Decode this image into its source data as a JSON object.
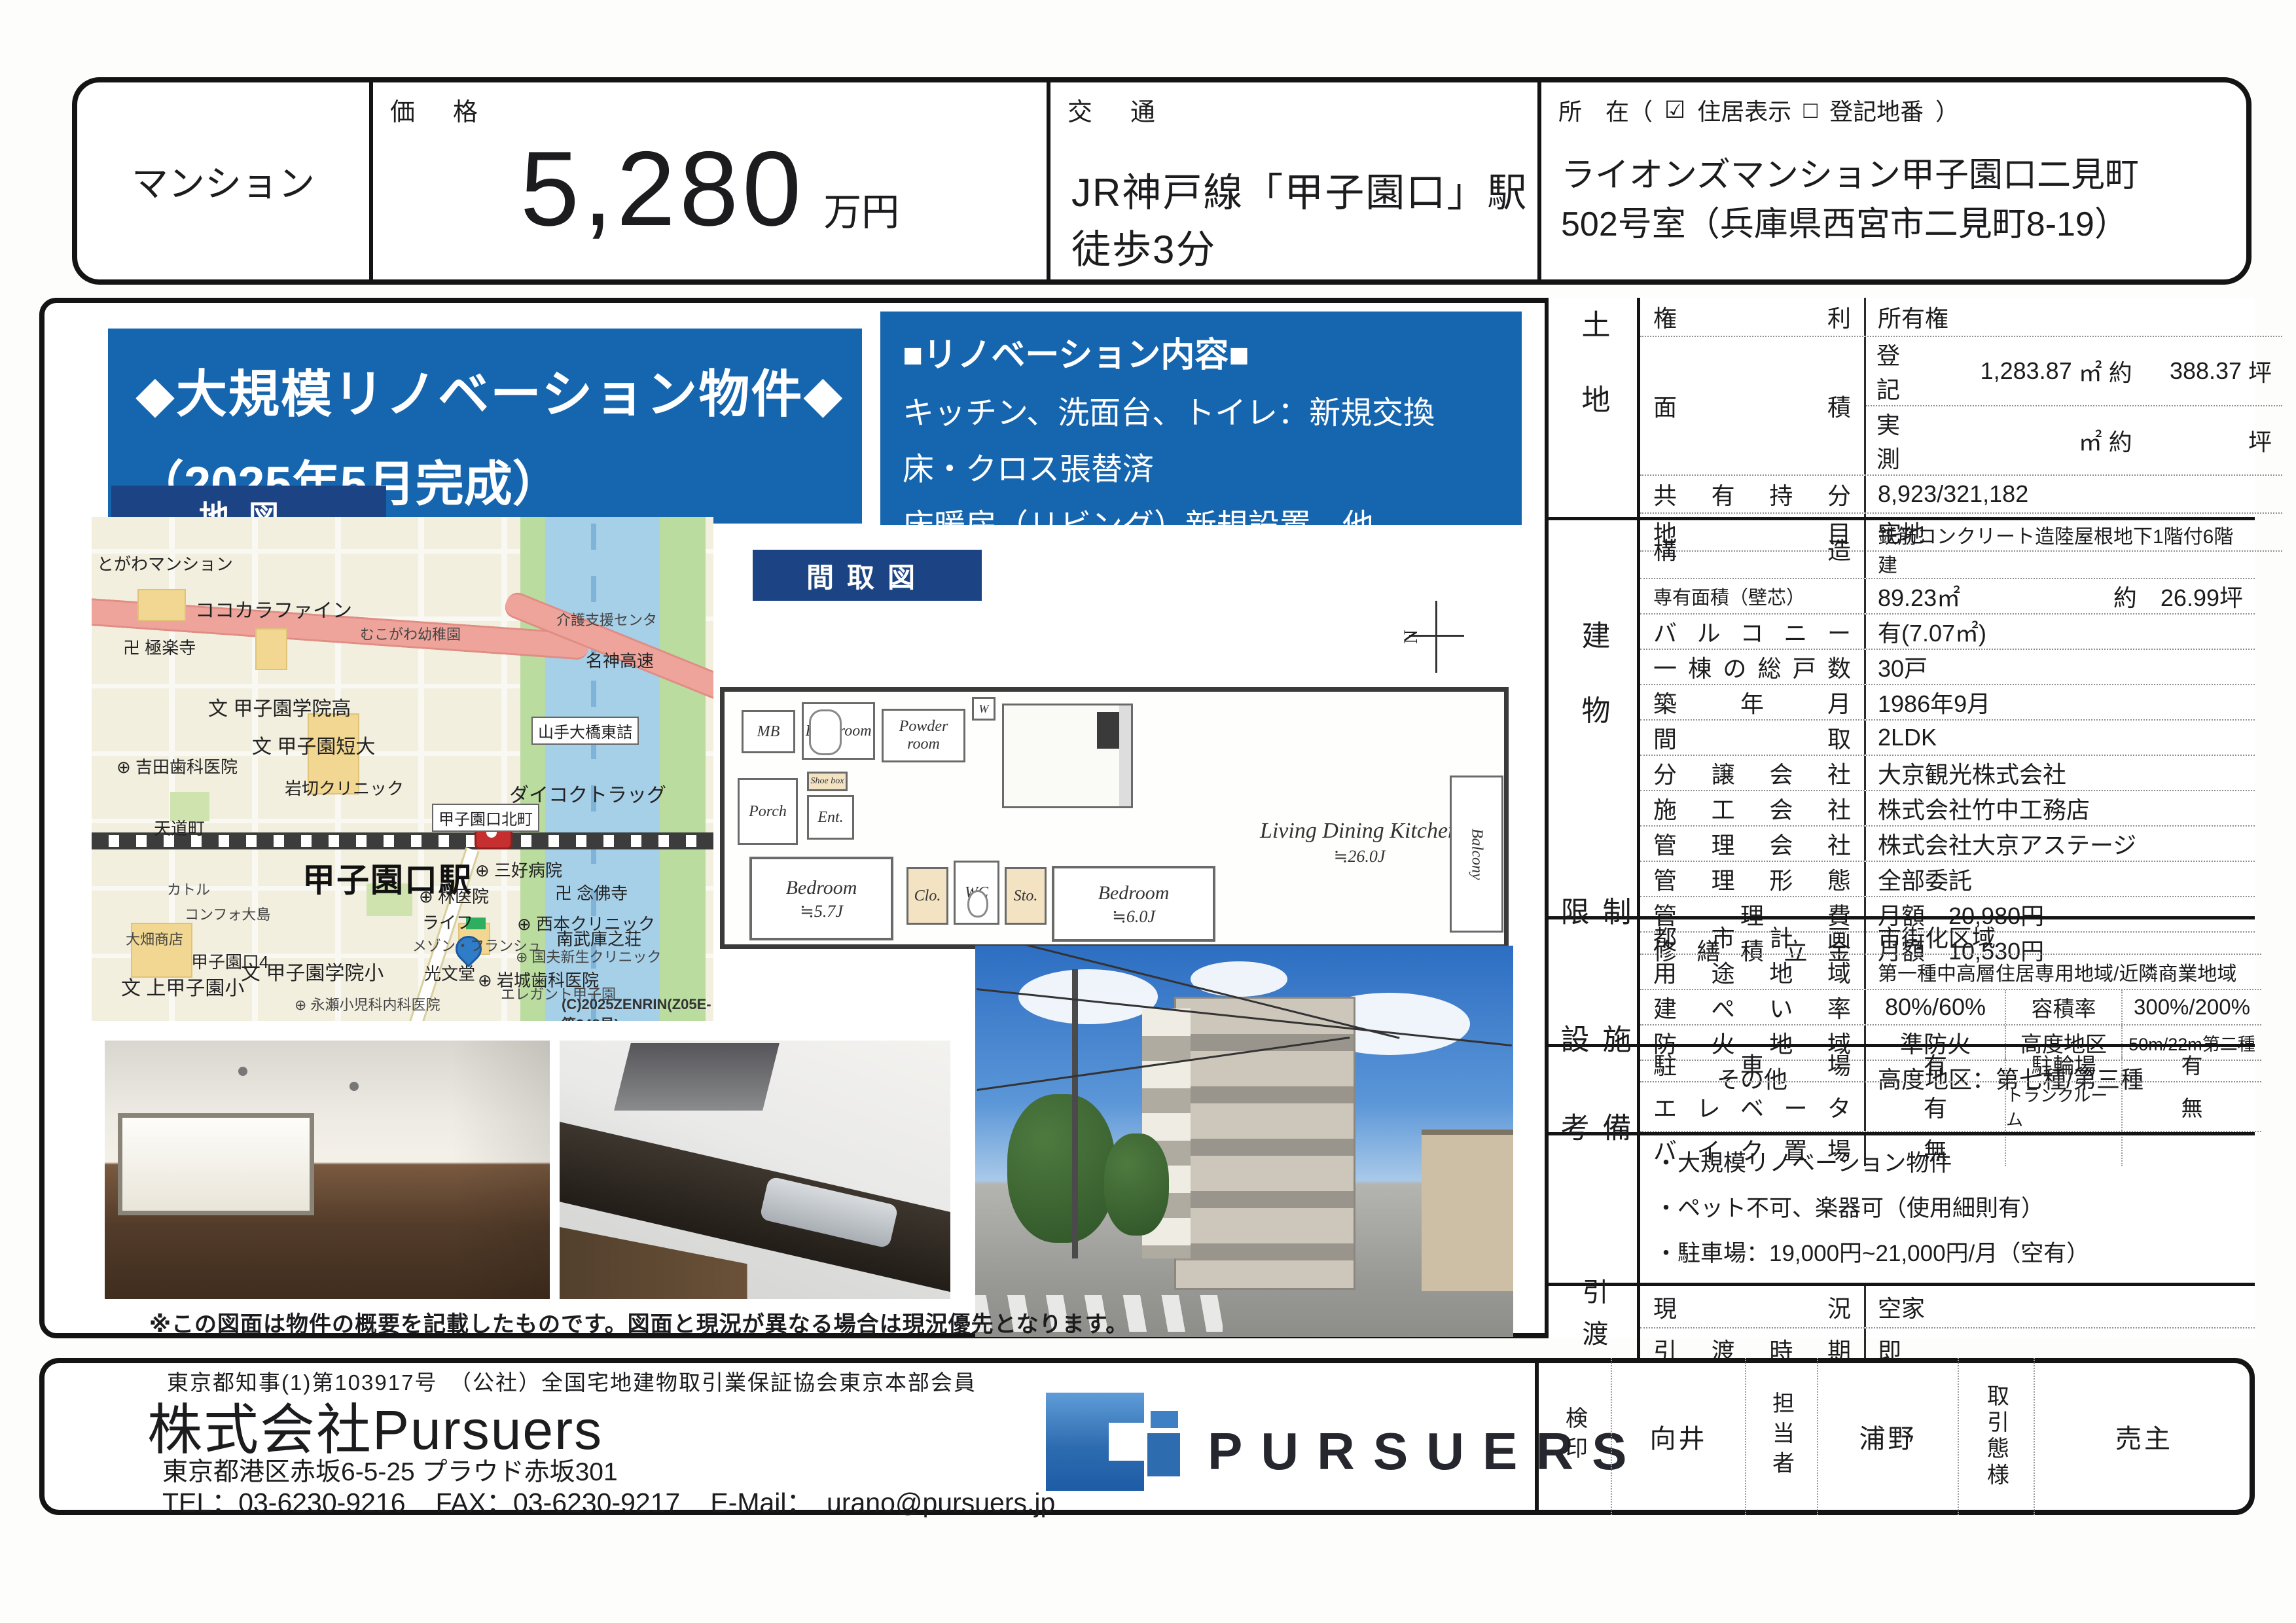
{
  "header": {
    "category": "マンション",
    "price_label": "価　格",
    "price_value": "5,280",
    "price_unit": "万円",
    "access_label": "交　通",
    "access_value": "JR神戸線「甲子園口」駅　徒歩3分",
    "location_label": "所　在（",
    "checkbox_checked_icon": "☑",
    "location_checked_text": "住居表示",
    "checkbox_unchecked_icon": "□",
    "location_unchecked_text": "登記地番",
    "location_paren_close": "）",
    "location_line1": "ライオンズマンション甲子園口二見町",
    "location_line2": "502号室（兵庫県西宮市二見町8-19）"
  },
  "highlight": {
    "line1": "◆大規模リノベーション物件◆",
    "line2": "（2025年5月完成）"
  },
  "renovation": {
    "title": "■リノベーション内容■",
    "items": [
      "キッチン、洗面台、トイレ：新規交換",
      "床・クロス張替済",
      "床暖房（リビング）新規設置　他"
    ]
  },
  "map": {
    "tag": "地図",
    "station": "甲子園口駅",
    "copyright": "(C)2025ZENRIN(Z05E-第348号)",
    "labels": [
      {
        "text": "とがわマンション"
      },
      {
        "text": "ココカラファイン"
      },
      {
        "text": "卍 極楽寺"
      },
      {
        "text": "むこがわ幼稚園"
      },
      {
        "text": "介護支援センタ"
      },
      {
        "text": "名神高速"
      },
      {
        "text": "文 甲子園学院高"
      },
      {
        "text": "文 甲子園短大"
      },
      {
        "text": "山手大橋東詰"
      },
      {
        "text": "⊕ 吉田歯科医院"
      },
      {
        "text": "岩切クリニック"
      },
      {
        "text": "ダイコクトラッグ"
      },
      {
        "text": "天道町"
      },
      {
        "text": "甲子園口北町"
      },
      {
        "text": "⊕ 三好病院"
      },
      {
        "text": "カトル"
      },
      {
        "text": "南武庫之荘"
      },
      {
        "text": "メゾン・フランシュ"
      },
      {
        "text": "文 甲子園学院小"
      },
      {
        "text": "⊕ 岩城歯科医院"
      },
      {
        "text": "コンフォ大島"
      },
      {
        "text": "大畑商店"
      },
      {
        "text": "⊕ 林医院"
      },
      {
        "text": "卍 念佛寺"
      },
      {
        "text": "ライフ"
      },
      {
        "text": "⊕ 西本クリニック"
      },
      {
        "text": "甲子園口4"
      },
      {
        "text": "文 上甲子園小"
      },
      {
        "text": "光文堂"
      },
      {
        "text": "⊕ 国夫新生クリニック"
      },
      {
        "text": "エレガント甲子園"
      },
      {
        "text": "⊕ 永瀬小児科内科医院"
      }
    ]
  },
  "floorplan": {
    "tag": "間取図",
    "north_label": "N",
    "rooms": {
      "mb": "MB",
      "bath": "Bath room",
      "powder": "Powder room",
      "washer": "W",
      "porch": "Porch",
      "entrance": "Ent.",
      "shoe": "Shoe box",
      "closet": "Clo.",
      "wc": "WC",
      "storage": "Sto.",
      "bedroom1_name": "Bedroom",
      "bedroom1_size": "≒5.7J",
      "bedroom2_name": "Bedroom",
      "bedroom2_size": "≒6.0J",
      "ldk_name": "Living Dining Kitchen",
      "ldk_size": "≒26.0J",
      "balcony": "Balcony"
    }
  },
  "land": {
    "title": "土地",
    "rights_label": "権利",
    "rights_value": "所有権",
    "area_label": "面積",
    "area_reg_k": "登記",
    "area_reg_m2": "1,283.87",
    "area_unit_m2": "㎡",
    "area_approx": "約",
    "area_reg_tsubo": "388.37",
    "area_unit_tsubo": "坪",
    "area_act_k": "実測",
    "area_act_m2": "",
    "area_act_tsubo": "",
    "share_label": "共有持分",
    "share_value": "8,923/321,182",
    "category_label": "地目",
    "category_value": "宅地"
  },
  "building": {
    "title": "建物",
    "rows": [
      {
        "label": "構造",
        "value": "鉄筋コンクリート造陸屋根地下1階付6階建"
      },
      {
        "label": "専有面積（壁芯）",
        "value": "89.23㎡",
        "value2": "約　26.99坪"
      },
      {
        "label": "バルコニー",
        "value": "有(7.07㎡)"
      },
      {
        "label": "一棟の総戸数",
        "value": "30戸"
      },
      {
        "label": "築年月",
        "value": "1986年9月"
      },
      {
        "label": "間取",
        "value": "2LDK"
      },
      {
        "label": "分譲会社",
        "value": "大京観光株式会社"
      },
      {
        "label": "施工会社",
        "value": "株式会社竹中工務店"
      },
      {
        "label": "管理会社",
        "value": "株式会社大京アステージ"
      },
      {
        "label": "管理形態",
        "value": "全部委託"
      },
      {
        "label": "管理費",
        "value": "月額　20,980円"
      },
      {
        "label": "修繕積立金",
        "value": "月額　10,530円"
      }
    ]
  },
  "restrictions": {
    "title": "制限",
    "rows": [
      {
        "label": "都市計画",
        "value": "市街化区域"
      },
      {
        "label": "用途地域",
        "value": "第一種中高層住居専用地域/近隣商業地域"
      },
      {
        "label": "建ぺい率",
        "value": "80%/60%",
        "label2": "容積率",
        "value2": "300%/200%"
      },
      {
        "label": "防火地域",
        "value": "準防火",
        "label2": "高度地区",
        "value2": "50m/22m第二種"
      },
      {
        "label": "その他",
        "value": "高度地区：第七種/第三種"
      }
    ]
  },
  "facilities": {
    "title": "施設",
    "rows": [
      {
        "label": "駐車場",
        "value": "有",
        "label2": "駐輪場",
        "value2": "有"
      },
      {
        "label": "エレベータ",
        "value": "有",
        "label2": "トランクルーム",
        "value2": "無"
      },
      {
        "label": "バイク置場",
        "value": "無",
        "label2": "",
        "value2": ""
      }
    ]
  },
  "remarks": {
    "title": "備考",
    "notes": [
      "・大規模リノベーション物件",
      "・ペット不可、楽器可（使用細則有）",
      "・駐車場：19,000円~21,000円/月（空有）"
    ]
  },
  "handover": {
    "title": "引渡",
    "rows": [
      {
        "label": "現況",
        "value": "空家"
      },
      {
        "label": "引渡時期",
        "value": "即"
      }
    ]
  },
  "disclaimer": "※この図面は物件の概要を記載したものです。図面と現況が異なる場合は現況優先となります。",
  "footer": {
    "license": "東京都知事(1)第103917号　（公社）全国宅地建物取引業保証協会東京本部会員",
    "company": "株式会社Pursuers",
    "address": "東京都港区赤坂6-5-25 プラウド赤坂301",
    "tel": "TEL：03-6230-9216",
    "fax": "FAX：03-6230-9217",
    "email": "E-Mail：　urano@pursuers.jp",
    "logo_text": "PURSUERS",
    "stamps": {
      "check": "検印",
      "name1": "向井",
      "role": "担当者",
      "name2": "浦野",
      "type_label": "取引態様",
      "type_value": "売主"
    }
  },
  "colors": {
    "banner_blue": "#1565af",
    "tag_navy": "#1c4383",
    "logo_blue": "#2e6cb0"
  }
}
